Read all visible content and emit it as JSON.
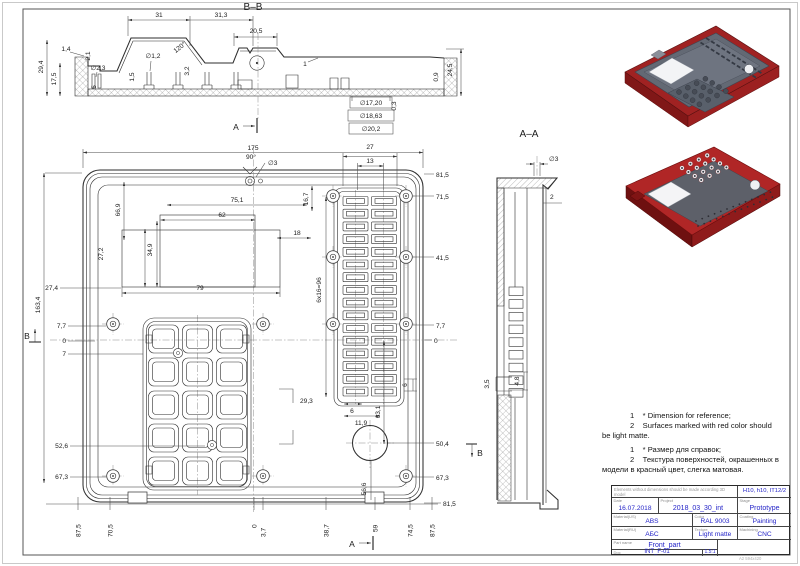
{
  "sheet": {
    "corner_note": "A2 594x420"
  },
  "bb": {
    "title": "B–B",
    "marker_a": "A",
    "w31": "31",
    "w313": "31,3",
    "w205": "20,5",
    "h294": "29,4",
    "h175": "17,5",
    "d14": "1,4",
    "d21": "2,1",
    "dia23": "∅2,3",
    "d5": "5",
    "d15": "1,5",
    "dia12": "∅1,2",
    "d32": "3,2",
    "ang120": "120°",
    "d1": "1",
    "dia1720": "∅17,20",
    "dia1863": "∅18,63",
    "dia202": "∅20,2",
    "d03": "0,3",
    "d09": "0,9",
    "h245": "24,5"
  },
  "front": {
    "marker_a": "A",
    "marker_b": "B",
    "w175": "175",
    "ang90": "90°",
    "dia3": "∅3",
    "w27": "27",
    "w13": "13",
    "h167": "16,7",
    "w751": "75,1",
    "w62": "62",
    "w18": "18",
    "w669": "66,9",
    "w272": "27,2",
    "w349": "34,9",
    "w79": "79",
    "h1634": "163,4",
    "h274": "27,4",
    "l77": "7,7",
    "l0": "0",
    "l7": "7",
    "l526": "52,6",
    "l673": "67,3",
    "r815": "81,5",
    "r715": "71,5",
    "r415": "41,5",
    "r77": "7,7",
    "r0": "0",
    "r504": "50,4",
    "r673": "67,3",
    "r815b": "81,5",
    "w293": "29,3",
    "vent_count": "6x16=96",
    "s6a": "6",
    "s6b": "6",
    "w119": "11,9",
    "h631": "63,1",
    "h566": "56,6",
    "b875l": "87,5",
    "b705": "70,5",
    "b0": "0",
    "b37": "3,7",
    "b387": "38,7",
    "b59": "59",
    "b745": "74,5",
    "b875r": "87,5"
  },
  "aa": {
    "title": "A–A",
    "dia3": "∅3",
    "d2": "2",
    "d35": "3,5",
    "d48": "4,8"
  },
  "notes": {
    "en1": "1    * Dimension for reference;",
    "en2": "2    Surfaces marked with red color should",
    "en3": "be light matte.",
    "ru1": "1    * Размер для справок;",
    "ru2": "2    Текстура поверхностей, окрашенных в",
    "ru3": "модели в красный цвет, слегка матовая."
  },
  "titleblock": {
    "general_note": "Elements without dimensions should be made according 3D model",
    "tolerance": "H10, h10, IT12/2",
    "date_label": "Date",
    "date": "16.07.2018",
    "project_label": "Project",
    "project": "2018_03_30_int",
    "stage_label": "Stage",
    "stage": "Prototype",
    "material_label": "Material(US)",
    "material": "ABS",
    "color_label": "Color",
    "color": "RAL 9003",
    "coating_label": "Coating",
    "coating": "Painting",
    "material_ru_label": "Material(RU)",
    "material_ru": "АБС",
    "texture_label": "Texture",
    "texture": "Light matte",
    "machining_label": "Machining",
    "machining": "CNC",
    "partname_label": "Part name",
    "partname": "Front_part",
    "doc_label": "Doc",
    "doc": "INT_F-01",
    "scale_label": "Scale",
    "scale": "1.5:1"
  },
  "colors": {
    "accent_blue": "#2424c8",
    "part_red": "#b02626",
    "part_gray": "#5d6069"
  }
}
